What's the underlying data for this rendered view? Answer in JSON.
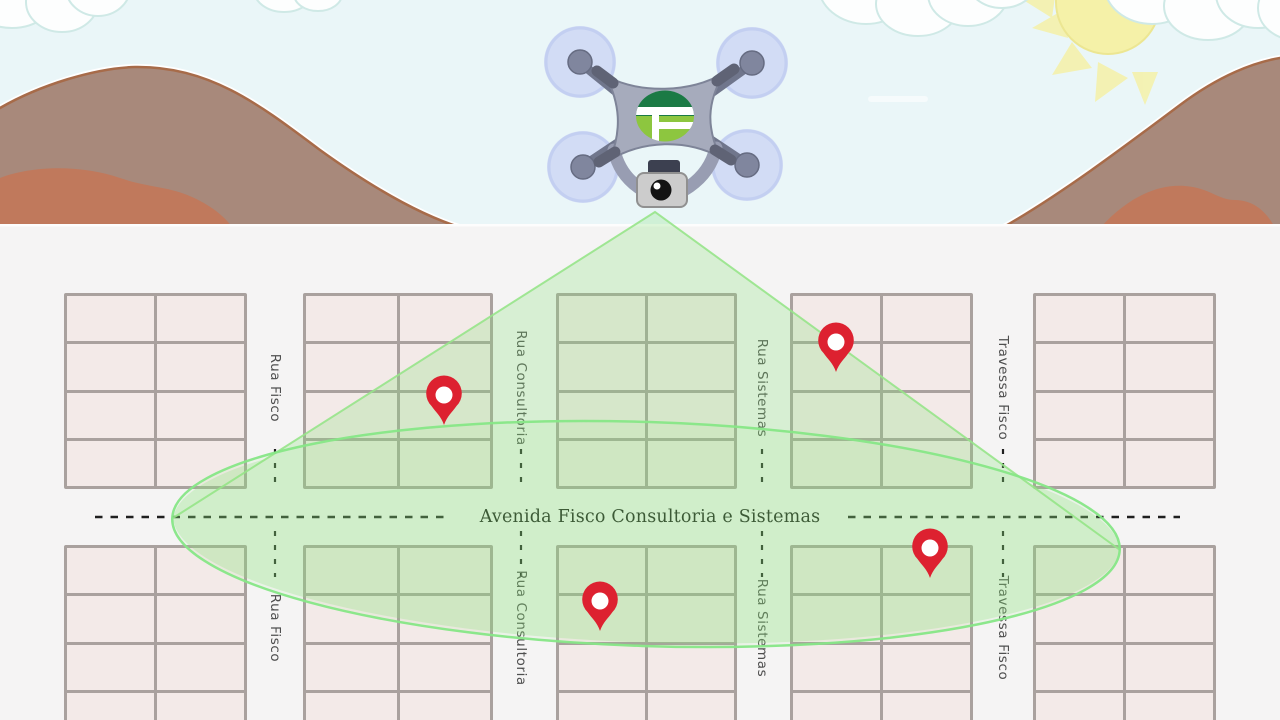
{
  "illustration": {
    "drone": {
      "logo_letter": "F"
    },
    "streets": {
      "avenue_label": "Avenida Fisco Consultoria e Sistemas",
      "vertical": [
        {
          "name": "Rua Fisco",
          "x": 275
        },
        {
          "name": "Rua Consultoria",
          "x": 521
        },
        {
          "name": "Rua Sistemas",
          "x": 762
        },
        {
          "name": "Travessa Fisco",
          "x": 1003
        }
      ]
    },
    "pins": [
      {
        "x": 444,
        "y": 425
      },
      {
        "x": 836,
        "y": 372
      },
      {
        "x": 930,
        "y": 578
      },
      {
        "x": 600,
        "y": 631
      }
    ],
    "colors": {
      "pin_red": "#dd2130",
      "scan_fill": "#88e07a",
      "scan_stroke": "#87e787",
      "block_fill": "#f3eae8",
      "block_border": "#a9a19e",
      "map_bg": "#f5f4f4",
      "sky": "#eaf6f8",
      "mountain": "#a8897b",
      "mountain_edge": "#a76b49",
      "foothill": "#c0795c",
      "sun": "#f5f1a8",
      "cloud": "#fdfefe",
      "cloud_edge": "#cfe9e6",
      "drone_body": "#a6abbc",
      "drone_dark": "#5f6375",
      "rotor": "#ccd6f4",
      "logo_dark_green": "#1b7a45",
      "logo_light_green": "#8dc63f",
      "street_text": "#4f4f4f",
      "avenue_text": "#151515",
      "dash": "#1f1f1f"
    }
  }
}
